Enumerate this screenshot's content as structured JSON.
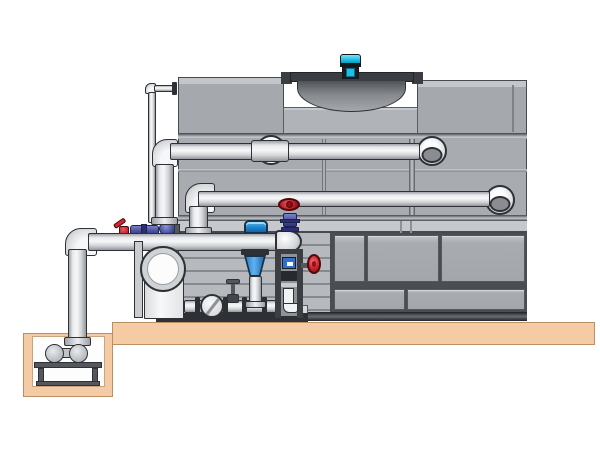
{
  "title": "",
  "visible_text": [],
  "colors": {
    "background": "#ffffff",
    "line": "#2e3135",
    "tower_face": "#a8abaf",
    "tower_face_light": "#c5c8cc",
    "tower_seam": "#4a4d52",
    "tower_block_highlight": "#c3c6ca",
    "fan_cowl": "#3a3d41",
    "drum_dark": "#505458",
    "drum_light": "#a4a8ad",
    "motor_cyan": "#1ac0e6",
    "motor_dark": "#15191d",
    "pipe_light": "#f6f7f8",
    "pipe_mid": "#d3d5d8",
    "pipe_dark": "#93969b",
    "steel": "#54575b",
    "skid_dark": "#2d3034",
    "slab_tan": "#f5cba6",
    "slab_border": "#bb8f64",
    "pit_interior": "#fdfdfd",
    "valve_red": "#d22730",
    "valve_red_dark": "#8c1216",
    "valve_red_border": "#4f0a0d",
    "valve_violet": "#4a52a0",
    "valve_violet_dark": "#2c2f6e",
    "valve_violet_light": "#7a82c8",
    "gauge_blue": "#2f6fd0",
    "pump_blue": "#2a77c4",
    "pump_blue_light": "#5fb2ee",
    "motor_cap_blue": "#1f7fc8"
  },
  "components": [
    "cooling-tower-casing",
    "fan-cowl",
    "fan-drum",
    "fan-motor",
    "riser-pipe-upper",
    "riser-pipe-lower",
    "makeup-line",
    "suction-header",
    "sump-pit",
    "sump-pump",
    "concrete-slab",
    "end-suction-pump",
    "vertical-inline-pump",
    "check-valve",
    "gate-valve",
    "red-handwheel-valve",
    "red-side-valve",
    "red-lever-valve",
    "butterfly-valve",
    "pipe-union",
    "pump-skid"
  ]
}
